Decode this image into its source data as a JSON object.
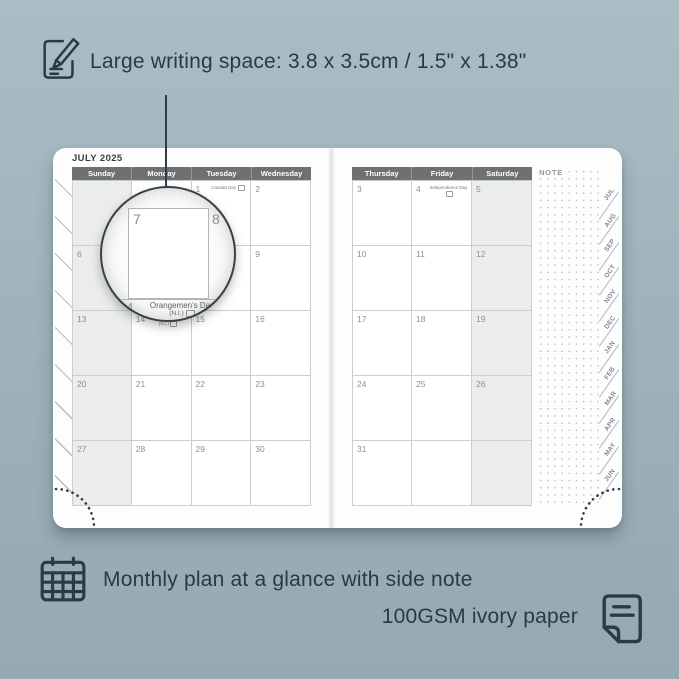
{
  "captions": {
    "top": "Large writing space: 3.8 x 3.5cm / 1.5\" x 1.38\"",
    "bottom_line1": "Monthly plan at a glance with side note",
    "bottom_line2": "100GSM ivory paper"
  },
  "icons": {
    "top_left": "pencil-note-icon",
    "bottom_left": "calendar-grid-icon",
    "bottom_right": "paper-sheet-icon"
  },
  "planner": {
    "month_title": "JULY 2025",
    "note_label": "NOTE",
    "left_page": {
      "day_headers": [
        "Sunday",
        "Monday",
        "Tuesday",
        "Wednesday"
      ],
      "shaded_column": 0,
      "rows": [
        [
          {
            "date": ""
          },
          {
            "date": ""
          },
          {
            "date": "1",
            "holiday": "Canada Day"
          },
          {
            "date": "2"
          }
        ],
        [
          {
            "date": "6"
          },
          {
            "date": "7"
          },
          {
            "date": "8"
          },
          {
            "date": "9"
          }
        ],
        [
          {
            "date": "13"
          },
          {
            "date": "14",
            "holiday": "Orangemen's Day (N.I.)"
          },
          {
            "date": "15"
          },
          {
            "date": "16"
          }
        ],
        [
          {
            "date": "20"
          },
          {
            "date": "21"
          },
          {
            "date": "22"
          },
          {
            "date": "23"
          }
        ],
        [
          {
            "date": "27"
          },
          {
            "date": "28"
          },
          {
            "date": "29"
          },
          {
            "date": "30"
          }
        ]
      ]
    },
    "right_page": {
      "day_headers": [
        "Thursday",
        "Friday",
        "Saturday"
      ],
      "shaded_column": 2,
      "rows": [
        [
          {
            "date": "3"
          },
          {
            "date": "4",
            "holiday": "Independence Day"
          },
          {
            "date": "5"
          }
        ],
        [
          {
            "date": "10"
          },
          {
            "date": "11"
          },
          {
            "date": "12"
          }
        ],
        [
          {
            "date": "17"
          },
          {
            "date": "18"
          },
          {
            "date": "19"
          }
        ],
        [
          {
            "date": "24"
          },
          {
            "date": "25"
          },
          {
            "date": "26"
          }
        ],
        [
          {
            "date": "31"
          },
          {
            "date": ""
          },
          {
            "date": ""
          }
        ]
      ]
    },
    "month_tabs": [
      "JUL",
      "AUG",
      "SEP",
      "OCT",
      "NOV",
      "DEC",
      "JAN",
      "FEB",
      "MAR",
      "APR",
      "MAY",
      "JUN"
    ],
    "magnifier": {
      "top_left_date": "7",
      "top_right_date": "8",
      "bottom_date": "14",
      "holiday_line1": "Orangemen's Day",
      "holiday_line2": "(N.I.)"
    }
  },
  "colors": {
    "background_top": "#abbcc4",
    "background_bottom": "#95a9b3",
    "ink": "#2c3b43",
    "page": "#fdfdfd",
    "header_bar": "#6e7173",
    "shaded_cell": "#ebecec",
    "grid_line": "#cbcdce",
    "date_text": "#8d8f91"
  }
}
